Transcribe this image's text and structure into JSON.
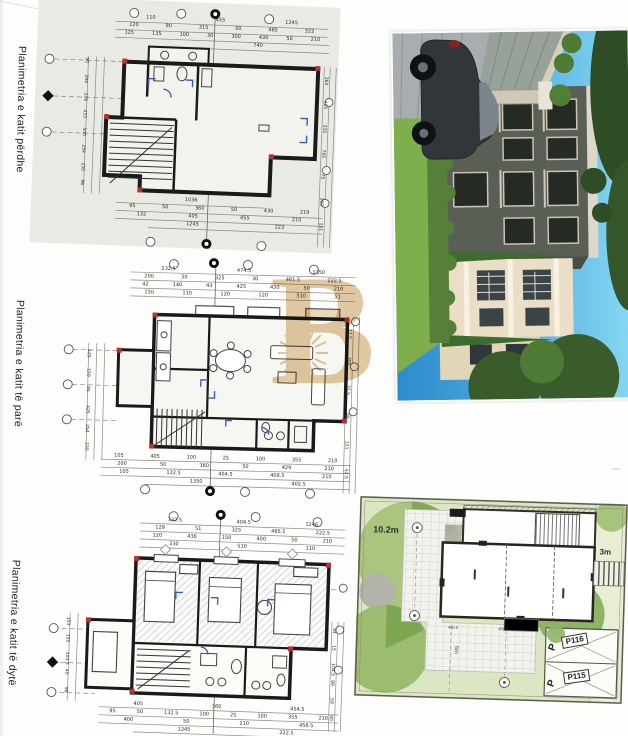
{
  "document": {
    "type": "scanned architectural sheet",
    "language": "Albanian"
  },
  "labels": {
    "plan1": "Planimetria e katit përdhe",
    "plan2": "Planimetria e katit të parë",
    "plan3": "Planimetria e katit të dytë"
  },
  "plans": [
    {
      "name": "ground-floor",
      "dims_top": [
        [
          "110",
          "455",
          "1245"
        ],
        [
          "120",
          "90",
          "315",
          "50",
          "485",
          "323"
        ],
        [
          "125",
          "135",
          "100",
          "30",
          "300",
          "430",
          "50",
          "210"
        ],
        [
          "740"
        ]
      ],
      "dims_bottom": [
        [
          "1036"
        ],
        [
          "95",
          "50",
          "360",
          "50",
          "430",
          "219"
        ],
        [
          "132",
          "405",
          "455",
          "210"
        ],
        [
          "1245",
          "223"
        ]
      ],
      "dims_left": [
        "90",
        "294",
        "378",
        "433",
        "500",
        "254",
        "230",
        "96"
      ],
      "dims_right": [
        "360",
        "415",
        "335",
        "795",
        "75",
        "100",
        "151"
      ]
    },
    {
      "name": "first-floor",
      "dims_top": [
        [
          "232.5",
          "474.5",
          "1350"
        ],
        [
          "200",
          "50",
          "325",
          "30",
          "461.5",
          "222.5"
        ],
        [
          "42",
          "140",
          "43",
          "425",
          "430",
          "50",
          "210"
        ],
        [
          "150",
          "110",
          "120",
          "120",
          "510",
          "51"
        ]
      ],
      "dims_bottom": [
        [
          "105",
          "405",
          "100",
          "25",
          "100",
          "355",
          "210"
        ],
        [
          "200",
          "50",
          "360",
          "50",
          "429",
          "210"
        ],
        [
          "105",
          "132.5",
          "404.5",
          "408.5",
          "210"
        ],
        [
          "1350",
          "402.5"
        ]
      ],
      "dims_left": [
        "125",
        "150",
        "95",
        "425",
        "254",
        "230"
      ],
      "dims_right": [
        "77.5",
        "300",
        "37.5",
        "98",
        "151",
        "52.5"
      ]
    },
    {
      "name": "second-floor",
      "dims_top": [
        [
          "132.5",
          "404.5",
          "1246"
        ],
        [
          "129",
          "51",
          "325",
          "465.5",
          "222.5"
        ],
        [
          "120",
          "436",
          "150",
          "400",
          "50",
          "210"
        ],
        [
          "330",
          "510",
          "110"
        ]
      ],
      "dims_bottom": [
        [
          "405",
          "360",
          "454.5"
        ],
        [
          "95",
          "50",
          "132.5",
          "100",
          "25",
          "100",
          "355",
          "210"
        ],
        [
          "400",
          "50",
          "210",
          "456.5"
        ],
        [
          "1245",
          "222.5"
        ]
      ],
      "dims_left": [
        "103",
        "150",
        "103.5",
        "40",
        "96"
      ],
      "dims_right": [
        "54",
        "15",
        "104.5",
        "99",
        "59",
        "90"
      ]
    }
  ],
  "site_plan": {
    "area_label": "10.2m",
    "offset_label": "3m",
    "walk_label": "6m",
    "parking": [
      "P116",
      "P115"
    ],
    "parking_letter": "P",
    "dims": [
      "400.5",
      "456.5"
    ]
  },
  "watermark": {
    "letter": "B",
    "color": "#dcbd8f"
  },
  "colors": {
    "plan_paper_tint": "#e9eae3",
    "wall_ink": "#1a1a1a",
    "red_mark": "#b13434",
    "blue_mark": "#3f5fae",
    "site_lawn": "#dce6c3",
    "site_tree": "#84a858",
    "render_sky_top": "#86d7f2",
    "render_sky_bottom": "#2d8ccc",
    "render_house_dark": "#5a5f55",
    "render_house_cream": "#eadfc6"
  }
}
